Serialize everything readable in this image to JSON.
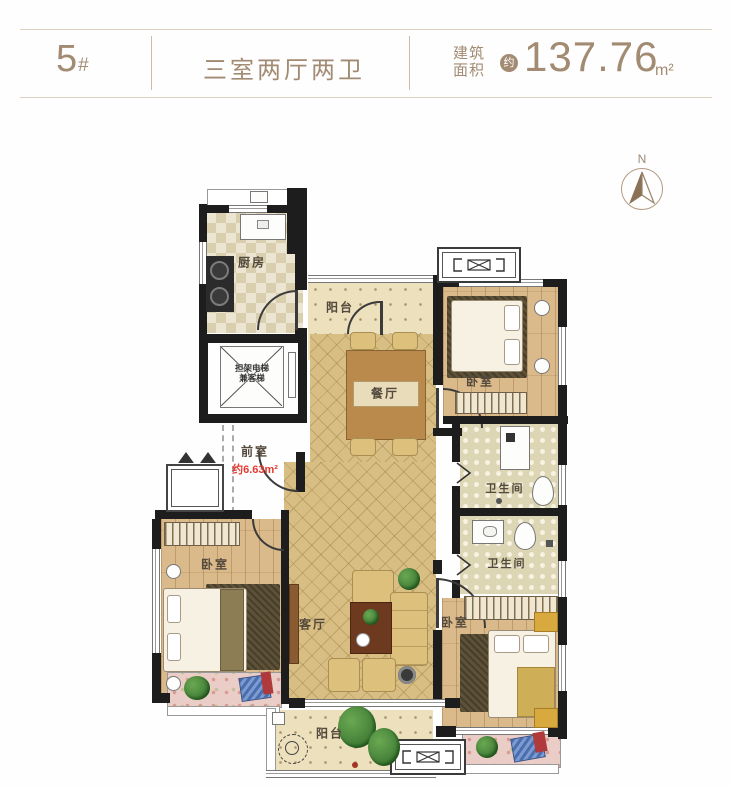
{
  "header": {
    "unit_number": "5",
    "unit_suffix": "#",
    "layout_type": "三室两厅两卫",
    "area_label_line1": "建筑",
    "area_label_line2": "面积",
    "approx_badge": "约",
    "area_value": "137.76",
    "area_unit": "m²"
  },
  "compass": {
    "north_label": "N"
  },
  "rooms": {
    "kitchen": "厨房",
    "balcony_top": "阳台",
    "dining": "餐厅",
    "elevator_line1": "担架电梯",
    "elevator_line2": "兼客梯",
    "front_room": "前室",
    "front_room_area": "约6.63m²",
    "bedroom_top_right": "卧室",
    "bathroom_top": "卫生间",
    "bathroom_bottom": "卫生间",
    "bedroom_left": "卧室",
    "living_room": "客厅",
    "bedroom_bottom_right": "卧室",
    "balcony_bottom": "阳台"
  },
  "colors": {
    "accent_tan": "#a28b72",
    "highlight_red": "#e23a30",
    "wall": "#1d1d1d",
    "floor_diamond": "#d8be83",
    "floor_wood": "#dab98b"
  }
}
